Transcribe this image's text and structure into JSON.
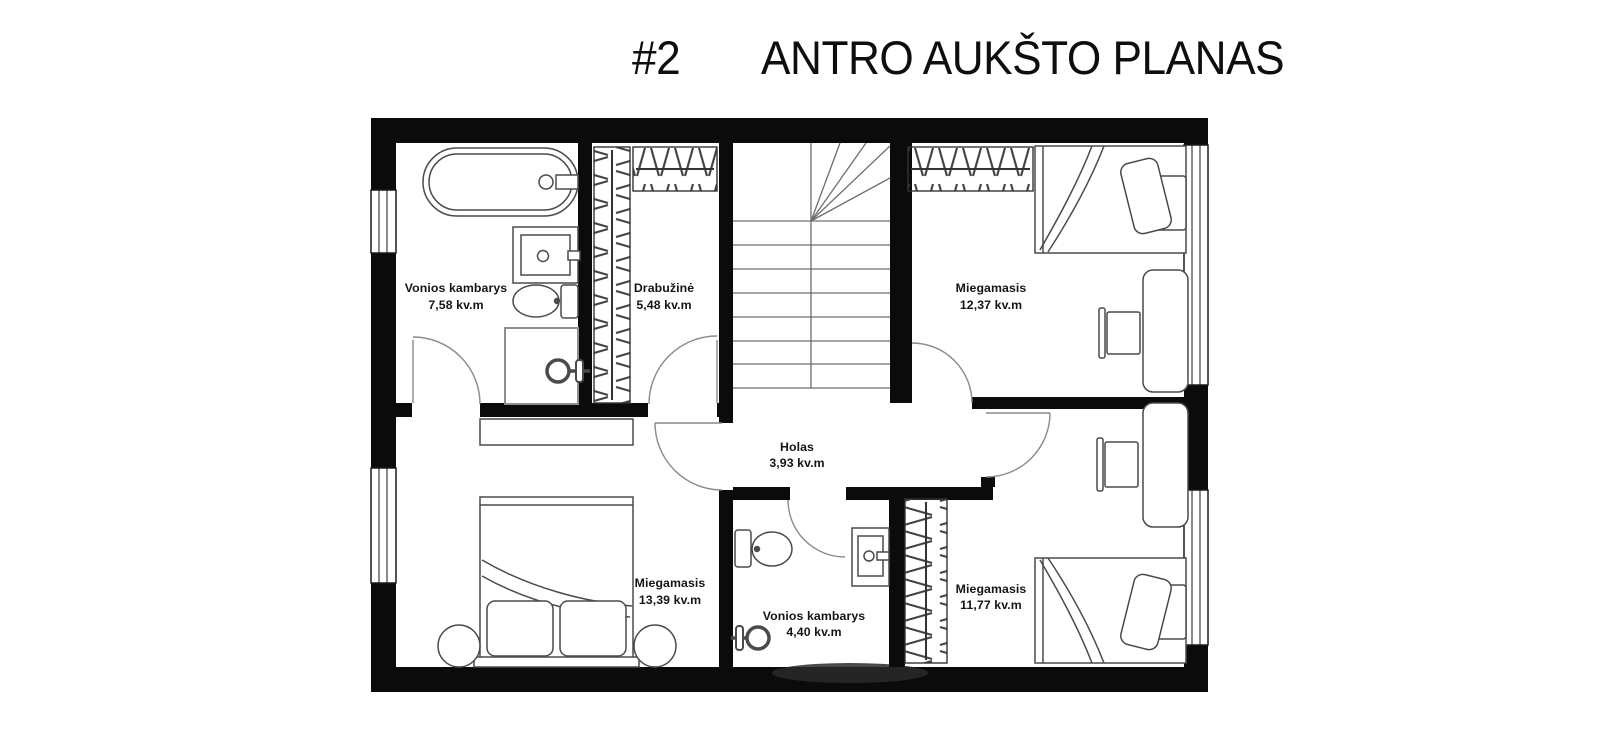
{
  "title": {
    "number": "#2",
    "text": "ANTRO AUKŠTO PLANAS"
  },
  "rooms": {
    "bathroom_main": {
      "name": "Vonios kambarys",
      "area": "7,58 kv.m"
    },
    "wardrobe": {
      "name": "Drabužinė",
      "area": "5,48 kv.m"
    },
    "bedroom_top_right": {
      "name": "Miegamasis",
      "area": "12,37 kv.m"
    },
    "hall": {
      "name": "Holas",
      "area": "3,93 kv.m"
    },
    "bedroom_bottom_left": {
      "name": "Miegamasis",
      "area": "13,39 kv.m"
    },
    "bathroom_small": {
      "name": "Vonios kambarys",
      "area": "4,40 kv.m"
    },
    "bedroom_bottom_right": {
      "name": "Miegamasis",
      "area": "11,77 kv.m"
    }
  },
  "icons": [
    "bathtub-icon",
    "sink-icon",
    "toilet-icon",
    "shower-head-icon",
    "shower-cabin-icon",
    "wardrobe-rack-icon",
    "stairs-icon",
    "bed-icon",
    "pillow-icon",
    "desk-icon",
    "chair-icon",
    "nightstand-icon",
    "dresser-icon",
    "door-arc-icon",
    "window-icon"
  ],
  "colors": {
    "wall": "#0b0b0b",
    "furniture_line": "#4a4a4a",
    "door_line": "#8a8a8a",
    "background": "#ffffff",
    "text": "#151515"
  }
}
